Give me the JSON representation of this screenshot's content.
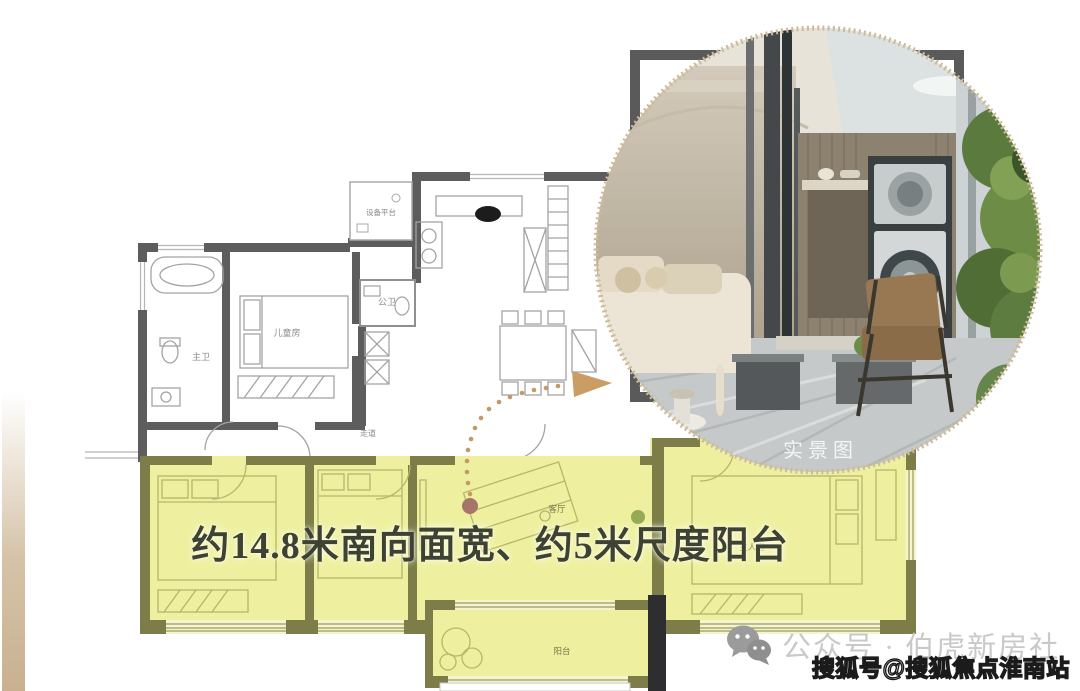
{
  "headline": {
    "text": "约14.8米南向面宽、约5米尺度阳台"
  },
  "photo": {
    "label": "实景图"
  },
  "floor_plan": {
    "rooms": {
      "equipment_platform": "设备平台",
      "guest_bathroom": "公卫",
      "master_bathroom": "主卫",
      "children_room": "儿童房",
      "corridor": "走道",
      "living_room": "客厅",
      "master_bedroom": "主人房",
      "balcony": "阳台"
    },
    "theme": {
      "highlight_yellow": "#eef0a0",
      "wall_gray": "#5d5d5d",
      "wall_olive": "#7c7d48",
      "arrow_brown": "#c49a6a",
      "headline_color": "#3e4233"
    }
  },
  "footer": {
    "wechat_account": "公众号 · 伯虎新房社",
    "watermark": "搜狐号@搜狐焦点淮南站"
  }
}
